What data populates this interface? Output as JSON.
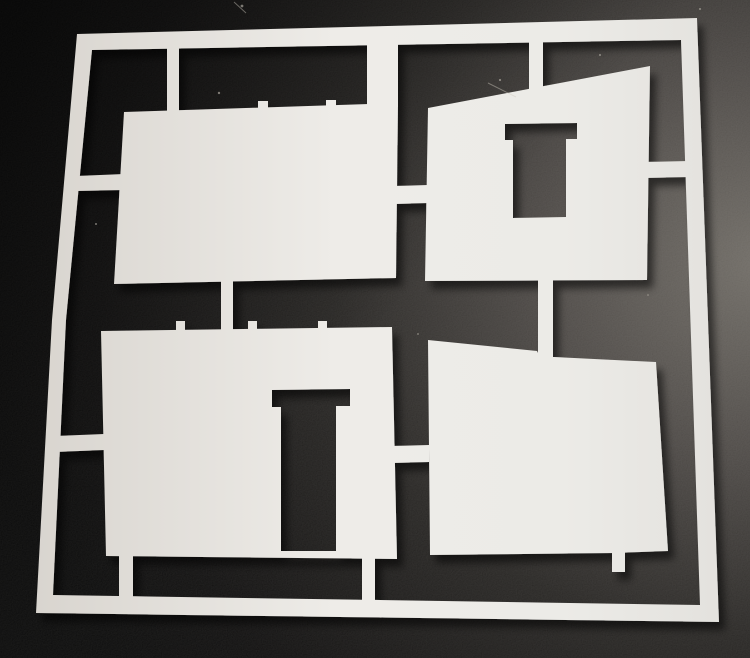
{
  "meta": {
    "description": "Photograph of a white laser-cut styrene sprue sheet lying on a dark textured surface. The sheet is a square frame holding four model-building wall panels attached by small tabs: a plain rectangular wall (top left), a wall with a slanted top and a rectangular window cutout (top right), a wall with a door cutout (bottom left), and a wall with a slanted top (bottom right)."
  },
  "scene": {
    "canvas": {
      "width": 750,
      "height": 658
    },
    "background": {
      "radial_center_x": 1.02,
      "radial_center_y": 0.4,
      "radial_radius": 1.05,
      "stops": [
        {
          "offset": 0.0,
          "color": "#6e6a64"
        },
        {
          "offset": 0.28,
          "color": "#4a4643"
        },
        {
          "offset": 0.55,
          "color": "#242220"
        },
        {
          "offset": 0.85,
          "color": "#0c0b0b"
        },
        {
          "offset": 1.0,
          "color": "#060606"
        }
      ],
      "corner_shade_color": "rgba(0,0,0,0.55)",
      "noise_opacity": 0.08
    },
    "sheet": {
      "gradient_stops": [
        {
          "offset": 0.0,
          "color": "#d6d2cc"
        },
        {
          "offset": 0.45,
          "color": "#eeece8"
        },
        {
          "offset": 0.75,
          "color": "#ecebe7"
        },
        {
          "offset": 1.0,
          "color": "#e2e0dc"
        }
      ],
      "shadow": {
        "dx": 6,
        "dy": 8,
        "blur": 4,
        "color": "#000000",
        "opacity": 0.55
      }
    },
    "shapes": [
      {
        "name": "sprue-frame",
        "subpaths": [
          [
            [
              77,
              34
            ],
            [
              697,
              18
            ],
            [
              719,
              622
            ],
            [
              36,
              613
            ],
            [
              52,
              320
            ]
          ],
          [
            [
              92,
              50
            ],
            [
              681,
              40
            ],
            [
              700,
              605
            ],
            [
              53,
              595
            ],
            [
              66,
              320
            ]
          ]
        ]
      },
      {
        "name": "panel-top-left-wall",
        "subpaths": [
          [
            [
              124,
              112
            ],
            [
              398,
              103
            ],
            [
              396,
              278
            ],
            [
              114,
              284
            ]
          ]
        ]
      },
      {
        "name": "panel-top-right-wall-with-window",
        "subpaths": [
          [
            [
              428,
              108
            ],
            [
              650,
              66
            ],
            [
              647,
              280
            ],
            [
              425,
              281
            ]
          ],
          [
            [
              505,
              124
            ],
            [
              577,
              123
            ],
            [
              577,
              139
            ],
            [
              566,
              139
            ],
            [
              566,
              217
            ],
            [
              513,
              218
            ],
            [
              513,
              140
            ],
            [
              505,
              140
            ]
          ]
        ]
      },
      {
        "name": "panel-bottom-left-wall-with-door",
        "subpaths": [
          [
            [
              101,
              331
            ],
            [
              392,
              327
            ],
            [
              397,
              559
            ],
            [
              106,
              556
            ]
          ],
          [
            [
              272,
              390
            ],
            [
              350,
              389
            ],
            [
              350,
              406
            ],
            [
              336,
              406
            ],
            [
              336,
              551
            ],
            [
              281,
              551
            ],
            [
              281,
              407
            ],
            [
              272,
              407
            ]
          ]
        ]
      },
      {
        "name": "panel-bottom-right-wall",
        "subpaths": [
          [
            [
              428,
              340
            ],
            [
              537,
              351
            ],
            [
              540,
              357
            ],
            [
              554,
              357
            ],
            [
              656,
              362
            ],
            [
              668,
              551
            ],
            [
              613,
              553
            ],
            [
              430,
              555
            ]
          ]
        ]
      },
      {
        "name": "sprue-tab-top-rail-to-panel1-left",
        "subpaths": [
          [
            [
              167,
              43
            ],
            [
              179,
              43
            ],
            [
              179,
              112
            ],
            [
              167,
              112
            ]
          ]
        ]
      },
      {
        "name": "sprue-tab-top-rail-to-panel1-right",
        "subpaths": [
          [
            [
              367,
              40
            ],
            [
              398,
              40
            ],
            [
              398,
              107
            ],
            [
              367,
              108
            ]
          ]
        ]
      },
      {
        "name": "sprue-tab-top-rail-to-panel2",
        "subpaths": [
          [
            [
              529,
              36
            ],
            [
              543,
              36
            ],
            [
              543,
              93
            ],
            [
              529,
              95
            ]
          ]
        ]
      },
      {
        "name": "sprue-tab-left-rail-to-panel1",
        "subpaths": [
          [
            [
              76,
              176
            ],
            [
              124,
              174
            ],
            [
              124,
              190
            ],
            [
              76,
              191
            ]
          ]
        ]
      },
      {
        "name": "sprue-tab-left-rail-to-panel3",
        "subpaths": [
          [
            [
              55,
              436
            ],
            [
              104,
              434
            ],
            [
              104,
              450
            ],
            [
              55,
              452
            ]
          ]
        ]
      },
      {
        "name": "sprue-tab-panel1-to-panel2",
        "subpaths": [
          [
            [
              395,
              186
            ],
            [
              428,
              185
            ],
            [
              428,
              203
            ],
            [
              395,
              204
            ]
          ]
        ]
      },
      {
        "name": "sprue-tab-panel1-to-panel3",
        "subpaths": [
          [
            [
              221,
              276
            ],
            [
              233,
              276
            ],
            [
              233,
              332
            ],
            [
              221,
              332
            ]
          ]
        ]
      },
      {
        "name": "sprue-tab-panel2-to-panel4",
        "subpaths": [
          [
            [
              538,
              275
            ],
            [
              553,
              275
            ],
            [
              553,
              359
            ],
            [
              538,
              358
            ]
          ]
        ]
      },
      {
        "name": "sprue-tab-panel2-to-right-rail",
        "subpaths": [
          [
            [
              644,
              162
            ],
            [
              689,
              161
            ],
            [
              689,
              177
            ],
            [
              644,
              178
            ]
          ]
        ]
      },
      {
        "name": "sprue-tab-panel3-to-bottom-rail-left",
        "subpaths": [
          [
            [
              119,
              554
            ],
            [
              133,
              554
            ],
            [
              133,
              602
            ],
            [
              119,
              601
            ]
          ]
        ]
      },
      {
        "name": "sprue-tab-panel3-to-bottom-rail-right",
        "subpaths": [
          [
            [
              362,
              556
            ],
            [
              375,
              556
            ],
            [
              375,
              613
            ],
            [
              362,
              612
            ]
          ]
        ]
      },
      {
        "name": "sprue-tab-panel3-to-panel4",
        "subpaths": [
          [
            [
              392,
              446
            ],
            [
              429,
              445
            ],
            [
              429,
              462
            ],
            [
              392,
              463
            ]
          ]
        ]
      },
      {
        "name": "broken-tab-stub-panel4-bottom",
        "subpaths": [
          [
            [
              612,
              551
            ],
            [
              625,
              551
            ],
            [
              625,
              572
            ],
            [
              612,
              572
            ]
          ]
        ]
      },
      {
        "name": "tab-remnant-nub-panel1-a",
        "subpaths": [
          [
            [
              258,
              101
            ],
            [
              268,
              101
            ],
            [
              268,
              109
            ],
            [
              258,
              109
            ]
          ]
        ]
      },
      {
        "name": "tab-remnant-nub-panel1-b",
        "subpaths": [
          [
            [
              326,
              100
            ],
            [
              336,
              100
            ],
            [
              336,
              108
            ],
            [
              326,
              108
            ]
          ]
        ]
      },
      {
        "name": "tab-remnant-nub-panel3-a",
        "subpaths": [
          [
            [
              176,
              321
            ],
            [
              185,
              321
            ],
            [
              185,
              330
            ],
            [
              176,
              330
            ]
          ]
        ]
      },
      {
        "name": "tab-remnant-nub-panel3-b",
        "subpaths": [
          [
            [
              248,
              321
            ],
            [
              257,
              321
            ],
            [
              257,
              330
            ],
            [
              248,
              330
            ]
          ]
        ]
      },
      {
        "name": "tab-remnant-nub-panel3-c",
        "subpaths": [
          [
            [
              318,
              321
            ],
            [
              327,
              321
            ],
            [
              327,
              330
            ],
            [
              318,
              330
            ]
          ]
        ]
      }
    ],
    "debris_specks": [
      {
        "cx": 242,
        "cy": 6,
        "r": 1.4
      },
      {
        "cx": 219,
        "cy": 93,
        "r": 1.2
      },
      {
        "cx": 500,
        "cy": 80,
        "r": 1.1
      },
      {
        "cx": 600,
        "cy": 55,
        "r": 1.0
      },
      {
        "cx": 96,
        "cy": 224,
        "r": 1.0
      },
      {
        "cx": 418,
        "cy": 334,
        "r": 0.9
      },
      {
        "cx": 648,
        "cy": 295,
        "r": 0.8
      },
      {
        "cx": 700,
        "cy": 9,
        "r": 1.0
      }
    ],
    "debris_fibers": [
      {
        "x1": 488,
        "y1": 83,
        "x2": 516,
        "y2": 97
      },
      {
        "x1": 234,
        "y1": 2,
        "x2": 246,
        "y2": 13
      }
    ],
    "speck_color": "#cfcabf"
  }
}
